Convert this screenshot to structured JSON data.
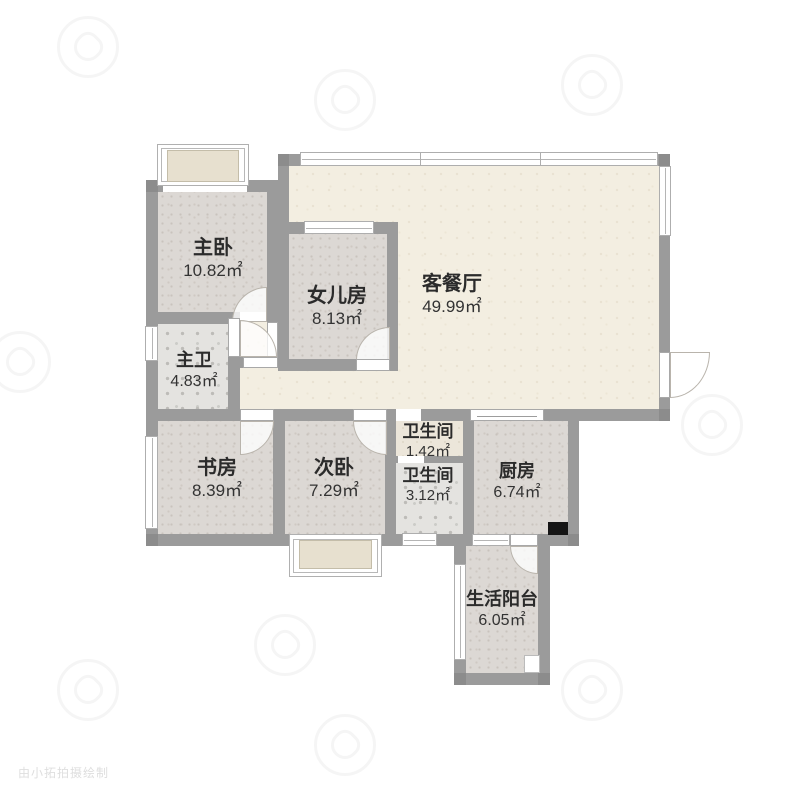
{
  "plan_title": "3室2厅户型图",
  "rooms": [
    {
      "id": "master-bedroom",
      "name": "主卧",
      "area": "10.82㎡"
    },
    {
      "id": "daughter-room",
      "name": "女儿房",
      "area": "8.13㎡"
    },
    {
      "id": "living-dining",
      "name": "客餐厅",
      "area": "49.99㎡"
    },
    {
      "id": "master-bath",
      "name": "主卫",
      "area": "4.83㎡"
    },
    {
      "id": "study",
      "name": "书房",
      "area": "8.39㎡"
    },
    {
      "id": "second-bedroom",
      "name": "次卧",
      "area": "7.29㎡"
    },
    {
      "id": "bathroom-small",
      "name": "卫生间",
      "area": "1.42㎡"
    },
    {
      "id": "bathroom-main",
      "name": "卫生间",
      "area": "3.12㎡"
    },
    {
      "id": "kitchen",
      "name": "厨房",
      "area": "6.74㎡"
    },
    {
      "id": "service-balcony",
      "name": "生活阳台",
      "area": "6.05㎡"
    }
  ],
  "watermark": {
    "credit": "由小拓拍摄绘制"
  },
  "colors": {
    "wall": "#9b9b9b",
    "living_floor": "#f3eee1",
    "room_floor": "#dcd8d4",
    "tile_floor": "#e4e3e0",
    "bay_fill": "#e7e0cf",
    "window_white": "#ffffff",
    "flue": "#151515",
    "label_text": "#2b2b2b"
  }
}
